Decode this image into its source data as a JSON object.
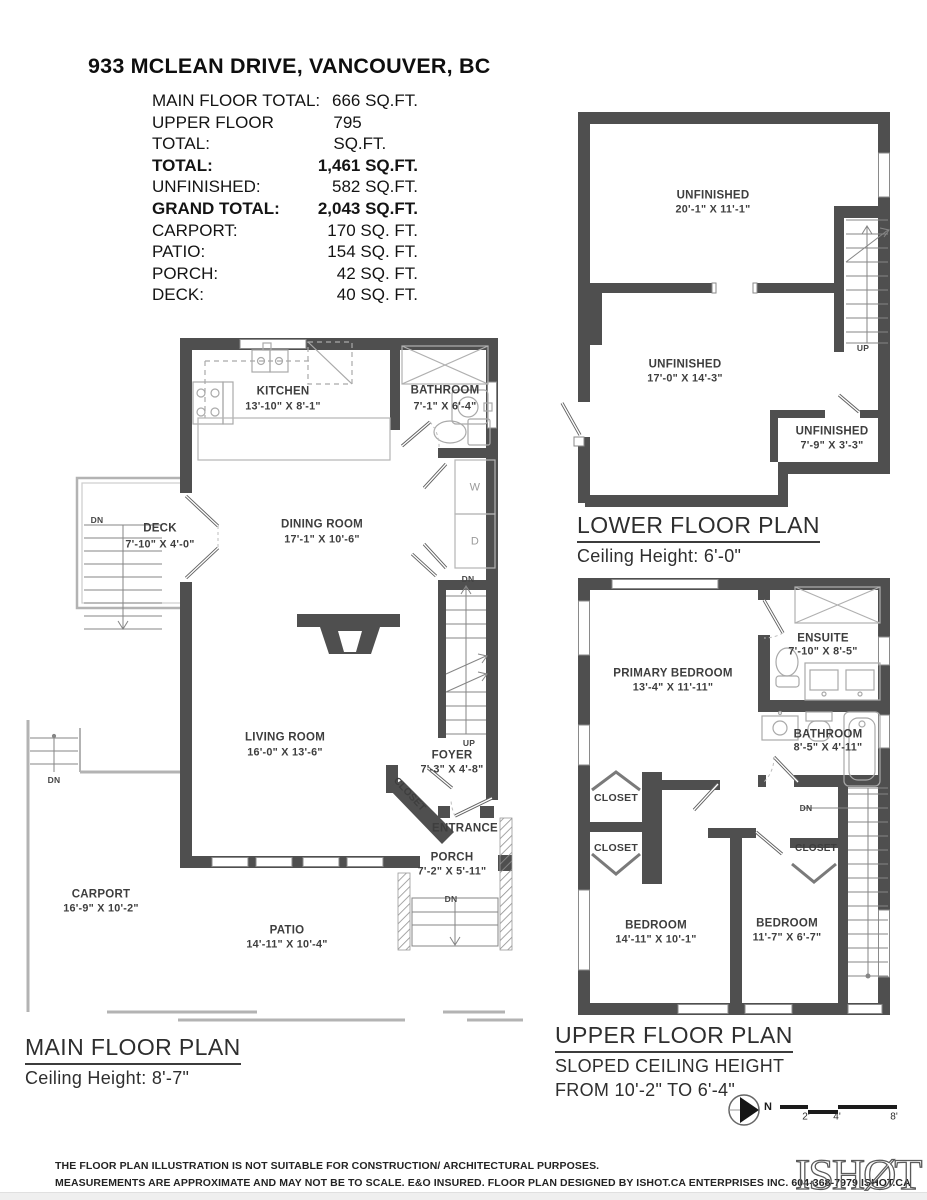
{
  "header": {
    "title": "933 MCLEAN DRIVE, VANCOUVER, BC",
    "summary": {
      "rows": [
        {
          "label": "MAIN FLOOR TOTAL:",
          "value": "666 SQ.FT."
        },
        {
          "label": "UPPER FLOOR TOTAL:",
          "value": "795 SQ.FT."
        },
        {
          "label": "TOTAL:",
          "value": "1,461 SQ.FT."
        },
        {
          "label": "UNFINISHED:",
          "value": "582 SQ.FT."
        },
        {
          "label": "GRAND TOTAL:",
          "value": "2,043 SQ.FT."
        },
        {
          "label": "CARPORT:",
          "value": "170 SQ. FT."
        },
        {
          "label": "PATIO:",
          "value": "154 SQ. FT."
        },
        {
          "label": "PORCH:",
          "value": "42 SQ. FT."
        },
        {
          "label": "DECK:",
          "value": "40 SQ. FT."
        }
      ]
    }
  },
  "plans": {
    "lower": {
      "title": "LOWER FLOOR PLAN",
      "subtitle": "Ceiling Height: 6'-0\"",
      "rooms": {
        "unfinished1": {
          "name": "UNFINISHED",
          "dims": "20'-1\" X 11'-1\""
        },
        "unfinished2": {
          "name": "UNFINISHED",
          "dims": "17'-0\" X 14'-3\""
        },
        "unfinished3": {
          "name": "UNFINISHED",
          "dims": "7'-9\" X 3'-3\""
        }
      },
      "stairs": {
        "up": "UP"
      }
    },
    "main": {
      "title": "MAIN FLOOR PLAN",
      "subtitle": "Ceiling Height: 8'-7\"",
      "rooms": {
        "kitchen": {
          "name": "KITCHEN",
          "dims": "13'-10\" X 8'-1\""
        },
        "bathroom": {
          "name": "BATHROOM",
          "dims": "7'-1\" X 6'-4\""
        },
        "dining": {
          "name": "DINING ROOM",
          "dims": "17'-1\" X 10'-6\""
        },
        "deck": {
          "name": "DECK",
          "dims": "7'-10\" X 4'-0\""
        },
        "living": {
          "name": "LIVING ROOM",
          "dims": "16'-0\" X 13'-6\""
        },
        "foyer": {
          "name": "FOYER",
          "dims": "7'-3\" X 4'-8\""
        },
        "closet": {
          "name": "CLOSET"
        },
        "entrance": {
          "name": "ENTRANCE"
        },
        "porch": {
          "name": "PORCH",
          "dims": "7'-2\" X 5'-11\""
        },
        "carport": {
          "name": "CARPORT",
          "dims": "16'-9\" X 10'-2\""
        },
        "patio": {
          "name": "PATIO",
          "dims": "14'-11\" X 10'-4\""
        }
      },
      "appliances": {
        "washer": "W",
        "dryer": "D"
      },
      "stairs": {
        "dn_top": "DN",
        "up_bottom": "UP",
        "deck_dn": "DN",
        "carport_dn": "DN",
        "porch_dn": "DN"
      }
    },
    "upper": {
      "title": "UPPER FLOOR PLAN",
      "subtitle1": "SLOPED CEILING HEIGHT",
      "subtitle2": "FROM 10'-2\" TO 6'-4\"",
      "rooms": {
        "primary": {
          "name": "PRIMARY BEDROOM",
          "dims": "13'-4\" X 11'-11\""
        },
        "ensuite": {
          "name": "ENSUITE",
          "dims": "7'-10\" X 8'-5\""
        },
        "bathroom": {
          "name": "BATHROOM",
          "dims": "8'-5\" X 4'-11\""
        },
        "closet1": {
          "name": "CLOSET"
        },
        "closet2": {
          "name": "CLOSET"
        },
        "closet3": {
          "name": "CLOSET"
        },
        "bedroom1": {
          "name": "BEDROOM",
          "dims": "14'-11\" X 10'-1\""
        },
        "bedroom2": {
          "name": "BEDROOM",
          "dims": "11'-7\" X 6'-7\""
        }
      },
      "stairs": {
        "dn": "DN"
      }
    }
  },
  "compass": {
    "label": "N"
  },
  "scale_bar": {
    "ticks": [
      "2'",
      "4'",
      "8'"
    ]
  },
  "footer": {
    "line1": "THE FLOOR PLAN ILLUSTRATION IS NOT SUITABLE FOR CONSTRUCTION/ ARCHITECTURAL PURPOSES.",
    "line2": "MEASUREMENTS ARE APPROXIMATE AND MAY NOT BE TO SCALE. E&O INSURED. FLOOR PLAN DESIGNED BY ISHOT.CA ENTERPRISES INC. 604-368-7979  ISHOT.CA",
    "logo_text": "ISHØT"
  }
}
